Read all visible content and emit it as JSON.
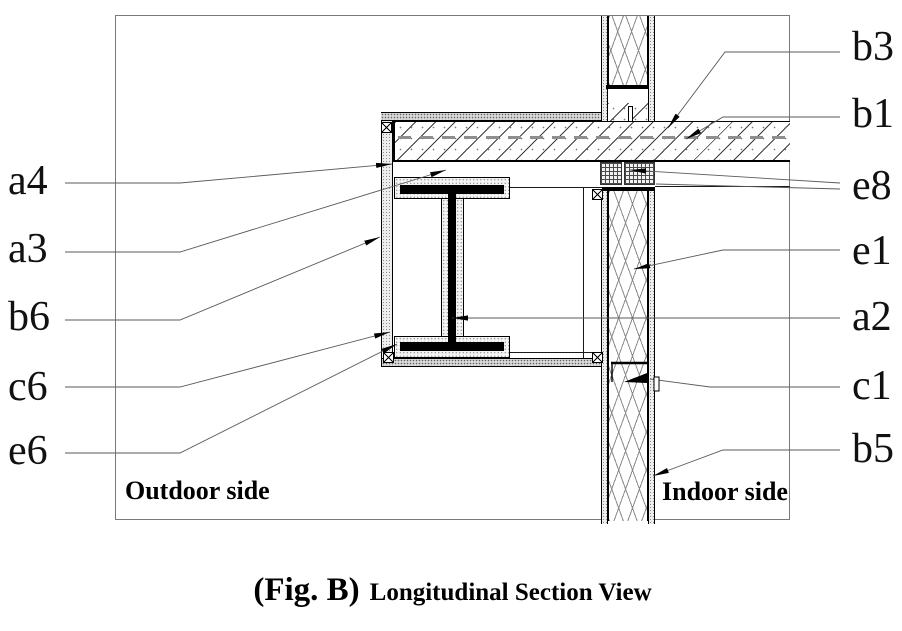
{
  "figure": {
    "fig_label": "(Fig. B)",
    "title": "Longitudinal Section View"
  },
  "regions": {
    "outdoor": "Outdoor side",
    "indoor": "Indoor side"
  },
  "callouts": {
    "left": [
      {
        "id": "a4",
        "text": "a4"
      },
      {
        "id": "a3",
        "text": "a3"
      },
      {
        "id": "b6",
        "text": "b6"
      },
      {
        "id": "c6",
        "text": "c6"
      },
      {
        "id": "e6",
        "text": "e6"
      }
    ],
    "right": [
      {
        "id": "b3",
        "text": "b3"
      },
      {
        "id": "b1",
        "text": "b1"
      },
      {
        "id": "e8",
        "text": "e8"
      },
      {
        "id": "e1",
        "text": "e1"
      },
      {
        "id": "a2",
        "text": "a2"
      },
      {
        "id": "c1",
        "text": "c1"
      },
      {
        "id": "b5",
        "text": "b5"
      }
    ]
  },
  "colors": {
    "drawing_line": "#000000",
    "leader_line": "#5a5a5a",
    "frame_line": "#7a7a7a",
    "background": "#ffffff"
  }
}
